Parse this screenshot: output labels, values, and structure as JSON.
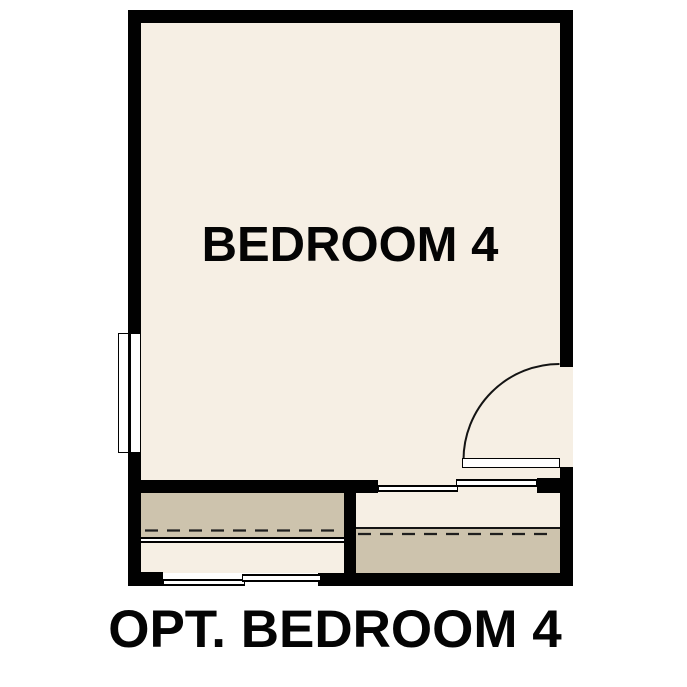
{
  "labels": {
    "room": "BEDROOM 4",
    "caption": "OPT. BEDROOM 4"
  },
  "colors": {
    "wall": "#010101",
    "floor": "#f6efe4",
    "shelf": "#cdc3ad",
    "outline": "#1a1a1a",
    "background": "#ffffff"
  }
}
